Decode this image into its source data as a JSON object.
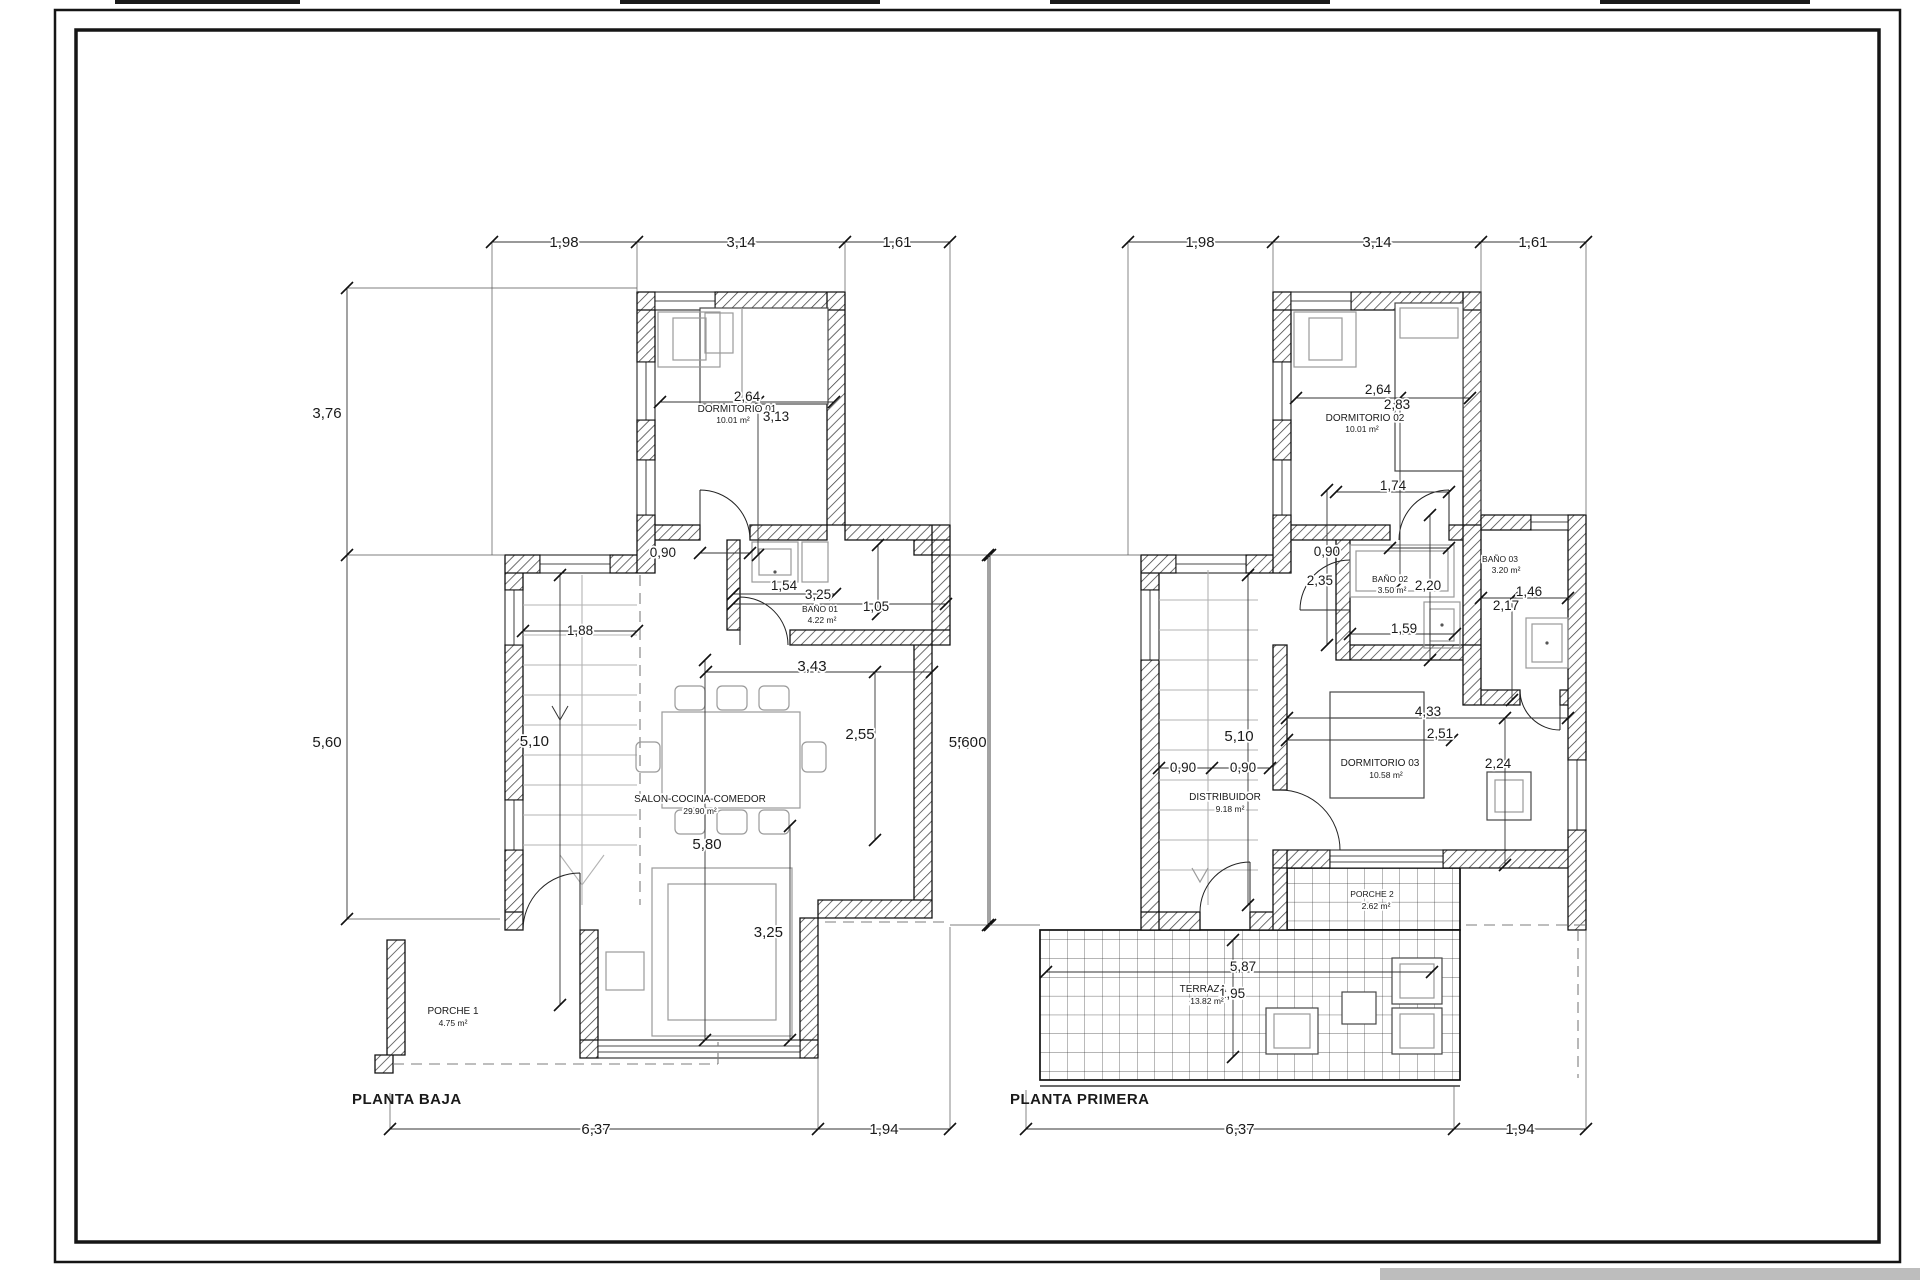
{
  "sheet": {
    "type": "architectural floor plan drawing"
  },
  "plans": [
    {
      "title": "PLANTA BAJA",
      "rooms": {
        "dormitorio01": {
          "name": "DORMITORIO 01",
          "area": "10.01 m²"
        },
        "bano01": {
          "name": "BAÑO 01",
          "area": "4.22 m²"
        },
        "salon": {
          "name": "SALON-COCINA-COMEDOR",
          "area": "29.90 m²"
        },
        "porche1": {
          "name": "PORCHE 1",
          "area": "4.75 m²"
        }
      },
      "dims": {
        "top": [
          "1,98",
          "3,14",
          "1,61"
        ],
        "left": [
          "3,76",
          "5,60"
        ],
        "right": [
          "5,60"
        ],
        "bottom": [
          "6,37",
          "1,94"
        ],
        "dorm_width": "2,64",
        "dorm_height": "3,13",
        "door": "0,90",
        "bath_inner": "1,54",
        "bath_width": "3,25",
        "bath_depth": "1,05",
        "stairs_width": "1,88",
        "stairs_run": "5,10",
        "salon_width": "3,43",
        "salon_right": "2,55",
        "salon_height": "5,80",
        "sofa_span": "3,25"
      }
    },
    {
      "title": "PLANTA PRIMERA",
      "rooms": {
        "dormitorio02": {
          "name": "DORMITORIO 02",
          "area": "10.01 m²"
        },
        "bano02": {
          "name": "BAÑO 02",
          "area": "3.50 m²"
        },
        "bano03": {
          "name": "BAÑO 03",
          "area": "3.20 m²"
        },
        "dormitorio03": {
          "name": "DORMITORIO 03",
          "area": "10.58 m²"
        },
        "distribuidor": {
          "name": "DISTRIBUIDOR",
          "area": "9.18 m²"
        },
        "porche2": {
          "name": "PORCHE 2",
          "area": "2.62 m²"
        },
        "terraza": {
          "name": "TERRAZA",
          "area": "13.82 m²"
        }
      },
      "dims": {
        "top": [
          "1,98",
          "3,14",
          "1,61"
        ],
        "bottom": [
          "6,37",
          "1,94"
        ],
        "left_height": "5,60",
        "dorm_width": "2,64",
        "dorm_inner": "2,83",
        "dorm_wall": "1,74",
        "dorm_door": "0,90",
        "bano02_height": "2,35",
        "bano02_inner": "2,20",
        "bano02_width": "1,59",
        "bano03_width": "1,46",
        "bano03_height": "2,17",
        "dorm03_width": "4,33",
        "dorm03_inner": "2,51",
        "dorm03_side": "2,24",
        "dist_run": "5,10",
        "dist_door_a": "0,90",
        "dist_door_b": "0,90",
        "terraza_width": "5,87",
        "terraza_depth": "1,95"
      }
    }
  ]
}
